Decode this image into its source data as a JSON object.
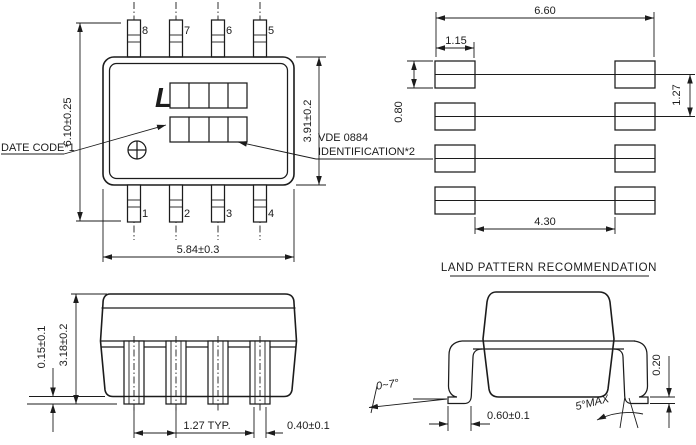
{
  "drawing": {
    "top_view": {
      "pins_top": [
        "8",
        "7",
        "6",
        "5"
      ],
      "pins_bottom": [
        "1",
        "2",
        "3",
        "4"
      ],
      "dim_lead_span": "6.10±0.25",
      "dim_body_width": "5.84±0.3",
      "dim_body_height": "3.91±0.2",
      "label_date_code": "DATE CODE*1",
      "label_vde_line1": "VDE 0884",
      "label_vde_line2": "IDENTIFICATION*2",
      "logo": "L"
    },
    "land_pattern": {
      "title": "LAND PATTERN RECOMMENDATION",
      "dim_total_width": "6.60",
      "dim_pad_width": "1.15",
      "dim_pad_height": "0.80",
      "dim_pitch": "1.27",
      "dim_inner_span": "4.30"
    },
    "side_view": {
      "dim_standoff": "0.15±0.1",
      "dim_height": "3.18±0.2",
      "dim_pitch": "1.27 TYP.",
      "dim_lead_width": "0.40±0.1"
    },
    "end_view": {
      "dim_lead_angle": "0~7°",
      "dim_foot_length": "0.60±0.1",
      "dim_side_angle": "5°MAX",
      "dim_lead_thickness": "0.20"
    },
    "colors": {
      "line": "#1c1c1c",
      "background": "#ffffff"
    }
  }
}
